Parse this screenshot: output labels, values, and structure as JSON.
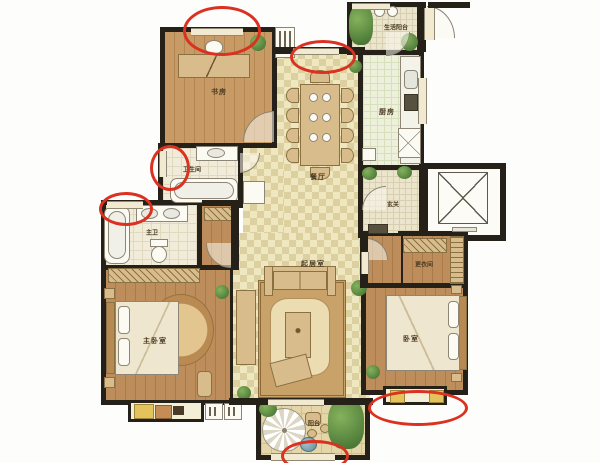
{
  "title": "三室两厅户型图",
  "colors": {
    "annotation_red": "#da3120",
    "wall": "#262118",
    "wood_floor": "#c0905c",
    "tile_floor": "#efe7bf"
  },
  "rooms": {
    "study": {
      "label": "书房"
    },
    "bathroom": {
      "label": "卫生间"
    },
    "master_bath": {
      "label": "主卫"
    },
    "master_bedroom": {
      "label": "主卧室"
    },
    "living_room": {
      "label": "起居室"
    },
    "dining_room": {
      "label": "餐厅"
    },
    "kitchen": {
      "label": "厨房"
    },
    "service_balcony": {
      "label": "生活阳台"
    },
    "foyer": {
      "label": "玄关"
    },
    "dressing_room": {
      "label": "更衣间"
    },
    "bedroom": {
      "label": "卧室"
    },
    "balcony": {
      "label": "阳台"
    }
  },
  "annotations": {
    "color": "#da3120",
    "marks": [
      {
        "name": "study-top-window"
      },
      {
        "name": "dining-top-window"
      },
      {
        "name": "bathroom-left-window"
      },
      {
        "name": "master-bath-window"
      },
      {
        "name": "bedroom-bottom-window"
      },
      {
        "name": "balcony-bottom-window"
      }
    ]
  }
}
